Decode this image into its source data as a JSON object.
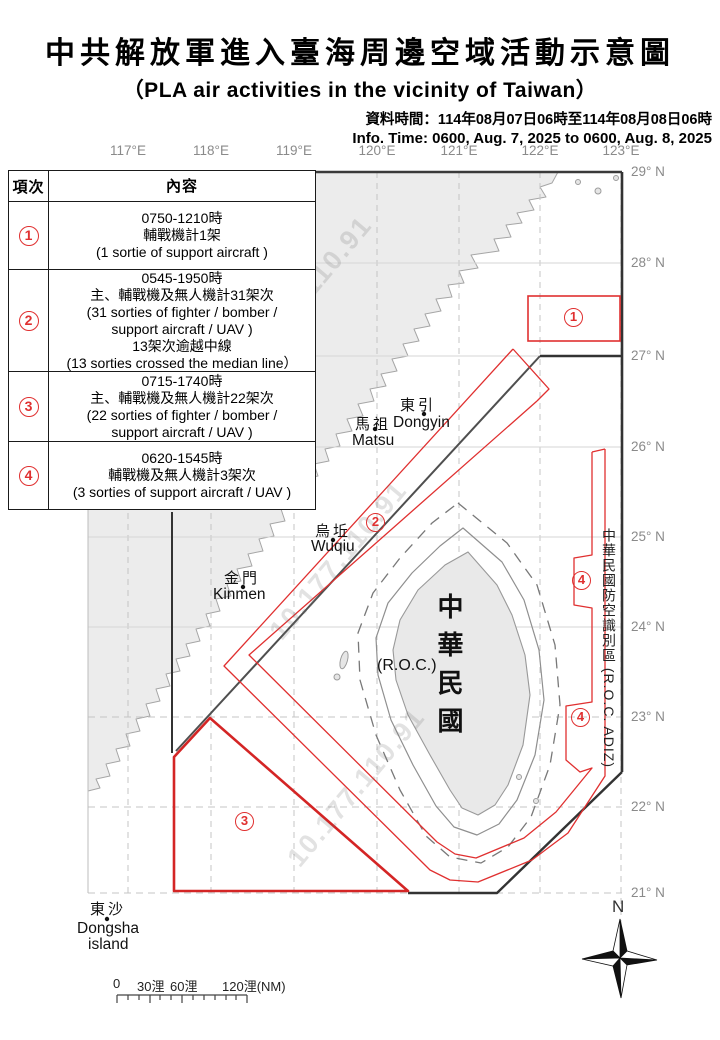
{
  "header": {
    "title_zh": "中共解放軍進入臺海周邊空域活動示意圖",
    "title_en": "（PLA air activities in the vicinity of Taiwan）",
    "data_time_zh": "資料時間：114年08月07日06時至114年08月08日06時",
    "data_time_en": "Info. Time: 0600, Aug. 7, 2025 to 0600, Aug. 8, 2025"
  },
  "table": {
    "col_item": "項次",
    "col_content": "內容",
    "rows": [
      {
        "num": "1",
        "content": "0750-1210時\n輔戰機計1架\n(1 sortie of support aircraft )"
      },
      {
        "num": "2",
        "content": "0545-1950時\n主、輔戰機及無人機計31架次\n(31 sorties of fighter / bomber /\nsupport aircraft / UAV )\n13架次逾越中線\n(13 sorties crossed the median line）"
      },
      {
        "num": "3",
        "content": "0715-1740時\n主、輔戰機及無人機計22架次\n(22 sorties of fighter / bomber /\nsupport aircraft / UAV )"
      },
      {
        "num": "4",
        "content": "0620-1545時\n輔戰機及無人機計3架次\n(3 sorties of support aircraft / UAV )"
      }
    ]
  },
  "map": {
    "lon_labels": [
      "117°E",
      "118°E",
      "119°E",
      "120°E",
      "121°E",
      "122°E",
      "123°E"
    ],
    "lat_labels": [
      "29° N",
      "28° N",
      "27° N",
      "26° N",
      "25° N",
      "24° N",
      "23° N",
      "22° N",
      "21° N"
    ],
    "places": {
      "dongyin_zh": "東引",
      "dongyin_en": "Dongyin",
      "matsu_zh": "馬祖",
      "matsu_en": "Matsu",
      "wuqiu_zh": "烏坵",
      "wuqiu_en": "Wuqiu",
      "kinmen_zh": "金門",
      "kinmen_en": "Kinmen",
      "dongsha_zh": "東沙",
      "dongsha_en": "Dongsha",
      "dongsha_en2": "island",
      "taiwan_zh": "中華民國",
      "taiwan_en": "(R.O.C.)"
    },
    "adiz_label_zh": "中華民國防空識別區",
    "adiz_label_en": " (R.O.C. ADIZ)",
    "zone_markers": [
      {
        "num": "1"
      },
      {
        "num": "2"
      },
      {
        "num": "3"
      },
      {
        "num": "4"
      },
      {
        "num": "4"
      }
    ],
    "compass_n": "N",
    "scale": {
      "t0": "0",
      "t30": "30浬",
      "t60": "60浬",
      "t120": "120浬(NM)"
    },
    "watermark": "10.177.110.91",
    "colors": {
      "zone_red": "#e03030",
      "adiz_black": "#333333",
      "median_gray": "#4f4f4f",
      "land_fill": "#ececec",
      "coast_gray": "#a6a6a6",
      "grid_gray": "#c4c4c4",
      "label_gray": "#8a8a8a"
    }
  }
}
